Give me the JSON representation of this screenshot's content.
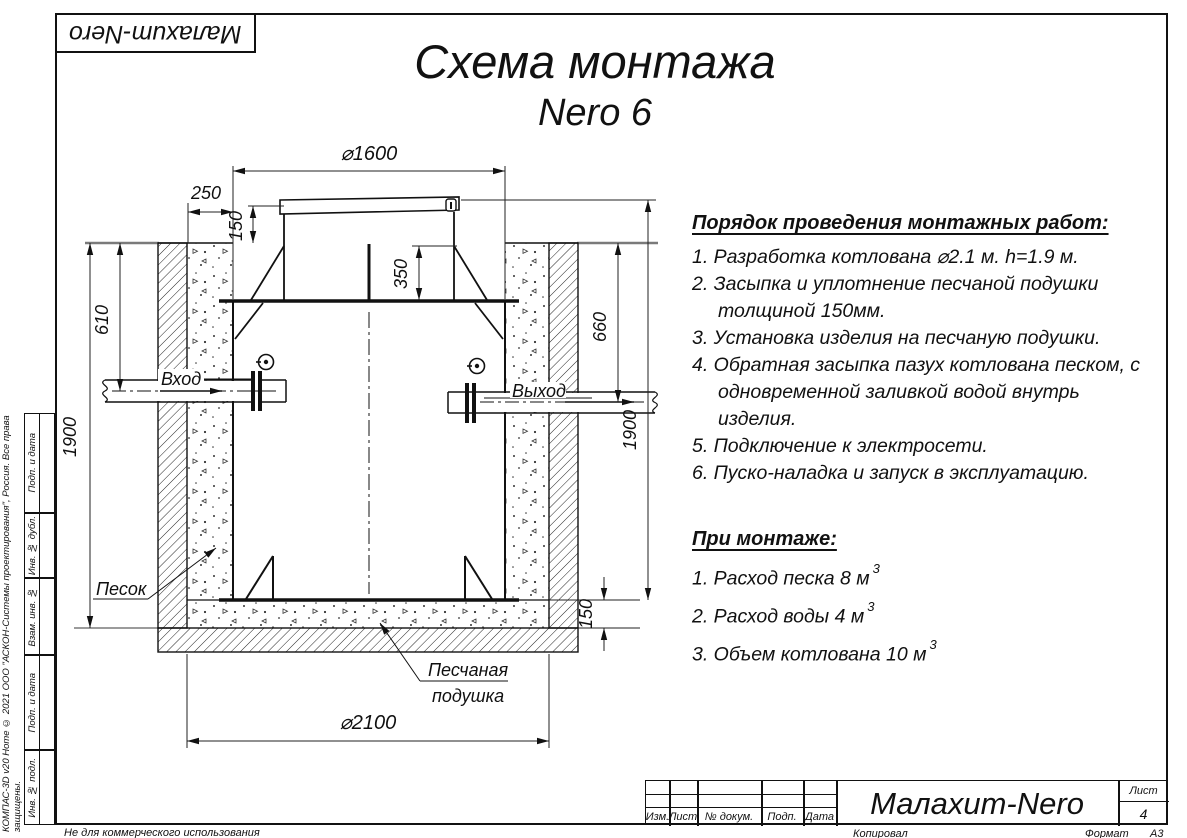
{
  "page": {
    "logo": "Малахит-Nero",
    "title": "Схема монтажа",
    "subtitle": "Nero 6",
    "copyright": "КОМПАС-3D v20 Home © 2021 ООО \"АСКОН-Системы проектирования\", Россия. Все права защищены.",
    "bottom_left_note": "Не для коммерческого использования",
    "kopiroval": "Копировал",
    "format_label": "Формат",
    "format_value": "А3"
  },
  "margin_stamps": [
    "Подп. и дата",
    "Инв. № дубл.",
    "Взам. инв. №",
    "Подп. и дата",
    "Инв. № подл."
  ],
  "title_block": {
    "columns": [
      "Изм.",
      "Лист",
      "№ докум.",
      "Подп.",
      "Дата"
    ],
    "doc_title": "Малахит-Nero",
    "sheet_label": "Лист",
    "sheet_number": "4"
  },
  "instructions": {
    "heading": "Порядок проведения монтажных работ:",
    "items": [
      "1. Разработка котлована ⌀2.1 м. h=1.9 м.",
      "2. Засыпка и уплотнение песчаной подушки толщиной 150мм.",
      "3. Установка изделия на песчаную подушки.",
      "4. Обратная засыпка пазух котлована песком, с одновременной заливкой водой внутрь изделия.",
      "5. Подключение к электросети.",
      "6. Пуско-наладка и запуск в эксплуатацию."
    ]
  },
  "montage": {
    "heading": "При монтаже:",
    "items": [
      {
        "text": "1. Расход песка 8 м",
        "sup": "3"
      },
      {
        "text": "2. Расход воды 4 м",
        "sup": "3"
      },
      {
        "text": "3. Объем котлована 10 м",
        "sup": "3"
      }
    ]
  },
  "drawing": {
    "dims": {
      "top_diameter": "⌀1600",
      "side_offset": "250",
      "lid_height": "150",
      "neck_depth": "350",
      "inlet_depth": "610",
      "pit_depth_left": "1900",
      "outlet_depth": "660",
      "pit_depth_right": "1900",
      "cushion_thickness": "150",
      "pit_diameter": "⌀2100"
    },
    "labels": {
      "inlet": "Вход",
      "outlet": "Выход",
      "sand": "Песок",
      "cushion_line1": "Песчаная",
      "cushion_line2": "подушка"
    }
  }
}
